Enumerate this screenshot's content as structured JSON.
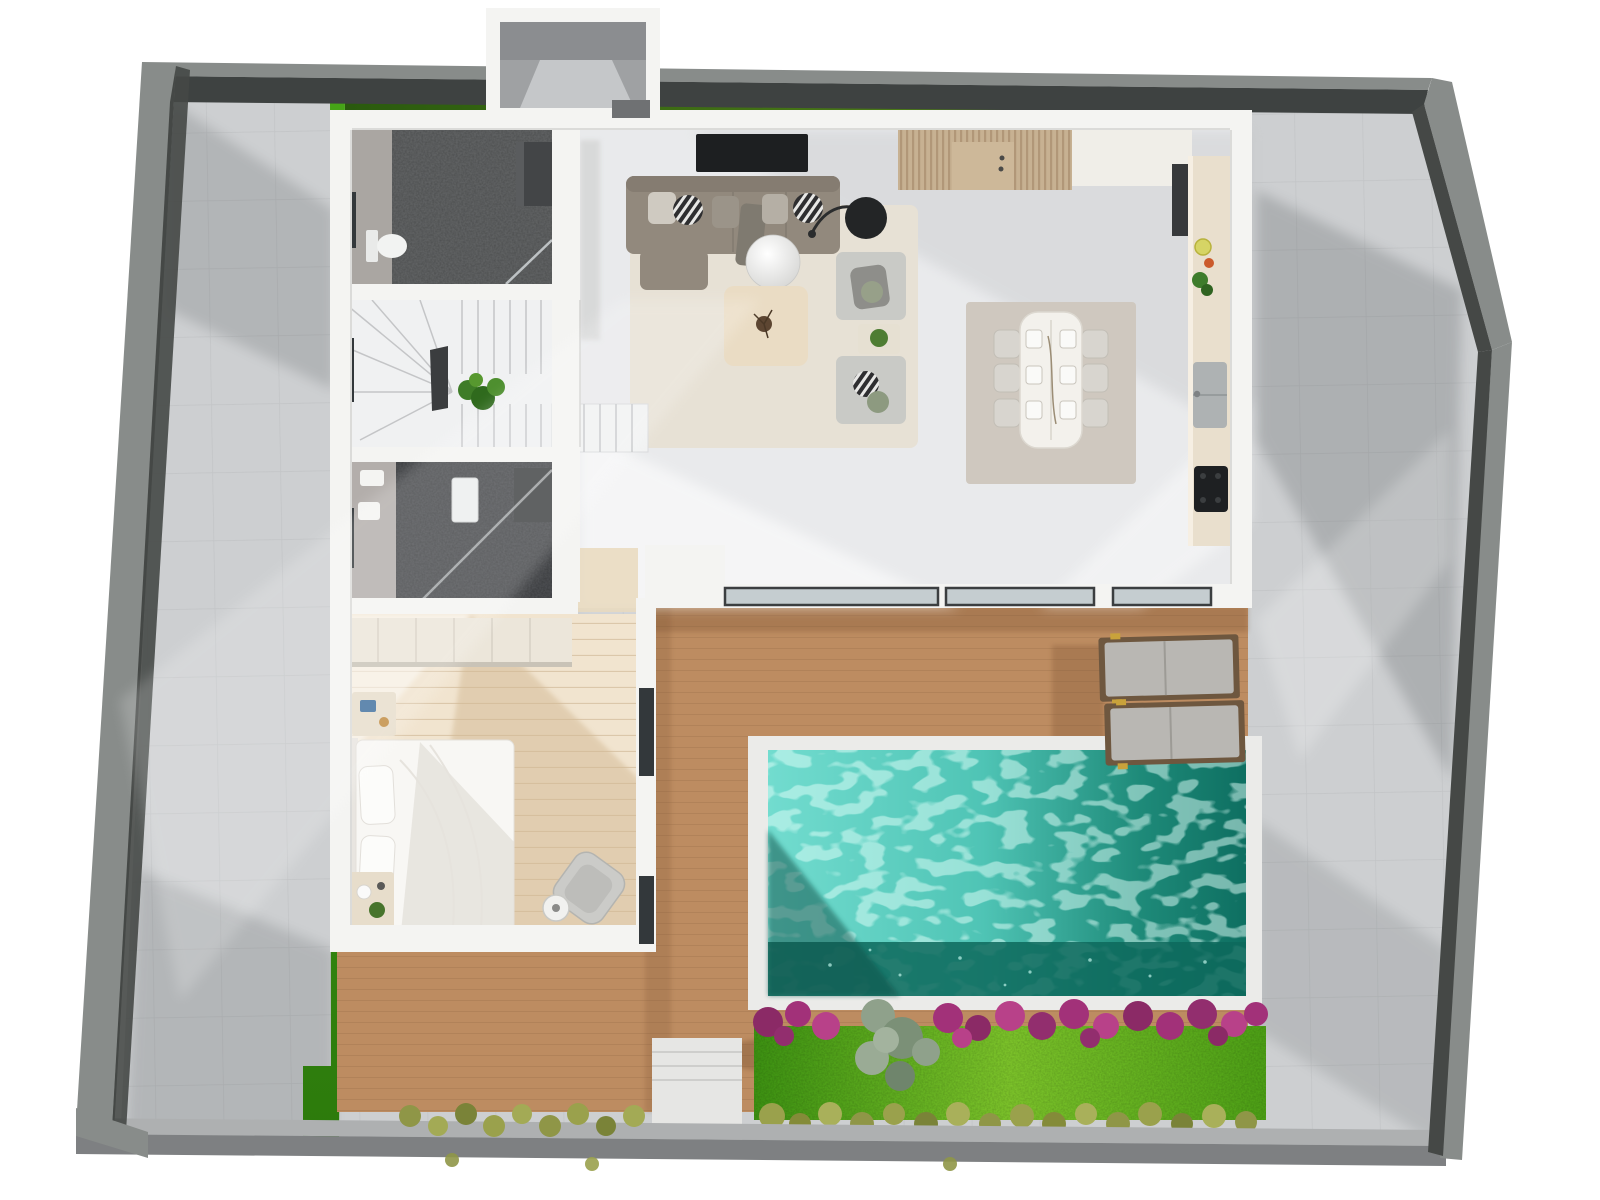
{
  "scene": {
    "kind": "3d-floor-plan-top-view",
    "subject": "single-storey villa with terrace, swimming pool and garden"
  },
  "objects": {
    "bathrooms": 2,
    "dining_chairs": 6,
    "dining_place_settings": 6,
    "sun_loungers": 2,
    "sliding_glass_panels": 3,
    "sofa_modules": 3,
    "armchair_modules": 2,
    "west_windows": 3,
    "bedroom_windows": 2
  },
  "palette": {
    "page_bg": "#ffffff",
    "wall_top": "#888c8a",
    "wall_face": "#3e4241",
    "garden_wall_top": "#aeb0b1",
    "garden_wall_face": "#7e8082",
    "paving": "#cdcfd1",
    "grass": "#3f9a14",
    "house_wall": "#f4f4f2",
    "floor": "#e9eaec",
    "bath_floor": "#5f6162",
    "bath2_floor": "#4b4d50",
    "bath_wall_band": "#aaa6a2",
    "bedroom_floor": "#f1e4cf",
    "wardrobe": "#ece6da",
    "terrace": "#bd8c61",
    "walkway": "#e6e6e4",
    "pool_coping": "#ebebe9",
    "pool_light": "#6cd9cc",
    "pool_deep": "#0d685c",
    "flower_magenta": "#a23179",
    "garden_green": "#58ad1c",
    "olive": "#939a48",
    "bush_green": "#8fa18b",
    "rug_living": "#e7e1d5",
    "rug_dining": "#cfc8bf",
    "sofa": "#92897d",
    "armchair": "#c9cac6",
    "coffee_table": "#eadcc4",
    "dining_table": "#f3f1ec",
    "chair": "#d8d5cf",
    "tv": "#1d1f21",
    "slats": "#c7b192",
    "counter": "#e9dfcd",
    "appliance_dark": "#37393b",
    "sink": "#aeb2b3",
    "cooktop": "#1e2022",
    "lounger_cushion": "#b9b7b3",
    "lounger_wood": "#6e573f",
    "lounger_gold": "#c9a23b",
    "glass": "#c5cdd0",
    "glass_frame": "#3b3e40",
    "window_dark": "#33383b",
    "bed_white": "#f8f7f4",
    "vestibule_floor": "#9fa1a3"
  }
}
